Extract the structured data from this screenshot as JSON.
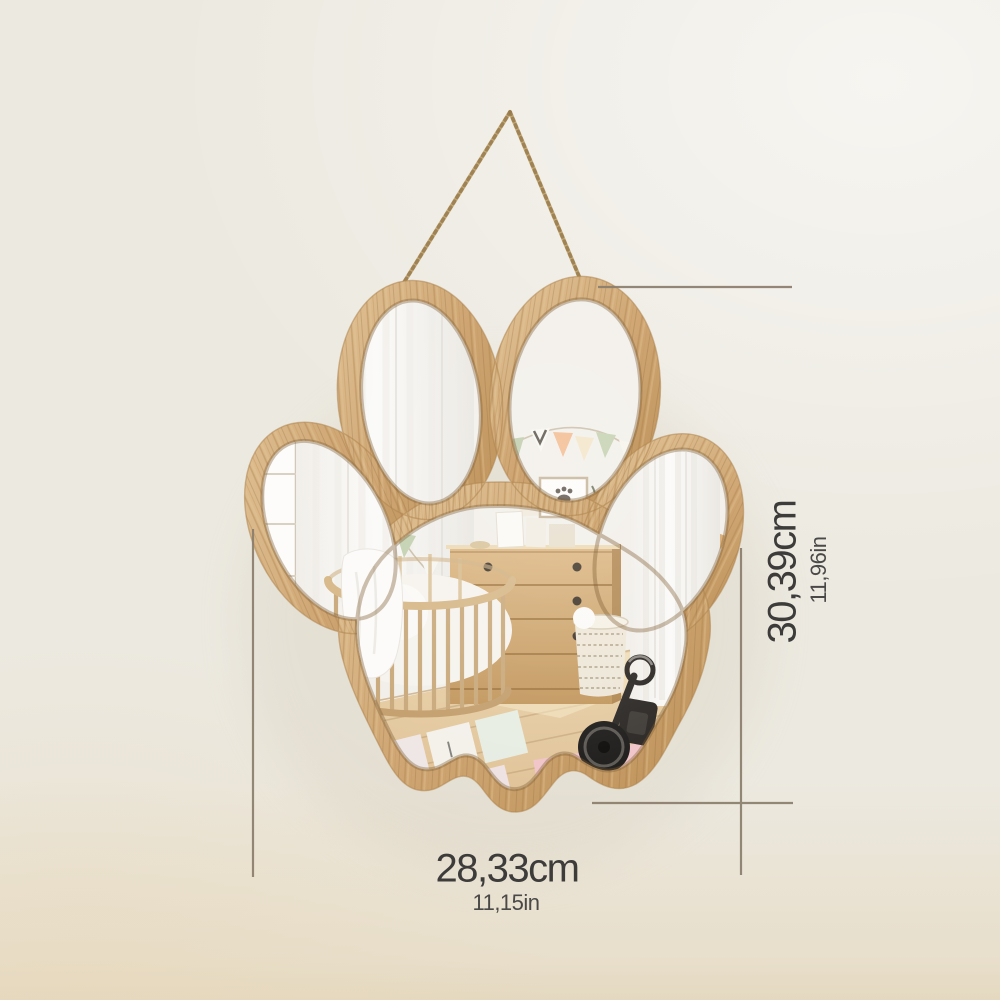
{
  "image": {
    "subject": "paw-print shaped wooden wall mirror hanging on a jute rope, reflecting a child's nursery room",
    "style": "product dimension photo"
  },
  "dimensions": {
    "height": {
      "cm": "30,39cm",
      "in": "11,96in"
    },
    "width": {
      "cm": "28,33cm",
      "in": "11,15in"
    }
  },
  "colors": {
    "background": "#ece9e0",
    "line": "#8b7e6d",
    "text_primary": "#3d3c3a",
    "text_secondary": "#4a4947",
    "wood": "#cda26c",
    "wood_dark": "#a87e47",
    "rope": "#c3a878",
    "mirror_wall": "#f2efe9"
  }
}
